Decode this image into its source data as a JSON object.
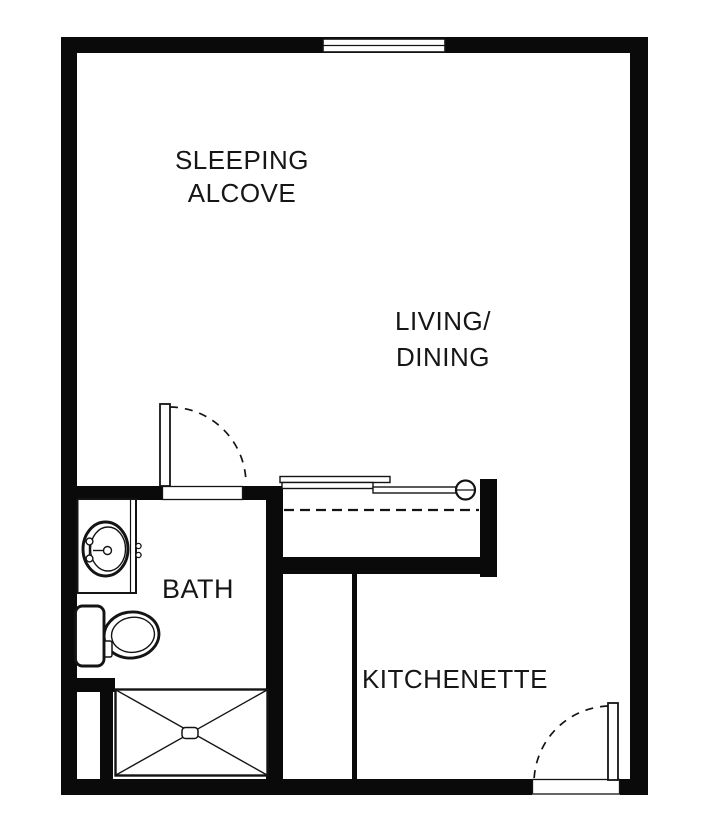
{
  "plan": {
    "rooms": [
      {
        "id": "sleeping-alcove",
        "lines": [
          "SLEEPING",
          "ALCOVE"
        ]
      },
      {
        "id": "living-dining",
        "lines": [
          "LIVING/",
          "DINING"
        ]
      },
      {
        "id": "bath",
        "lines": [
          "BATH"
        ]
      },
      {
        "id": "kitchenette",
        "lines": [
          "KITCHENETTE"
        ]
      }
    ],
    "colors": {
      "wall": "#0a0a0a",
      "linework": "#141414",
      "background": "#ffffff"
    }
  }
}
